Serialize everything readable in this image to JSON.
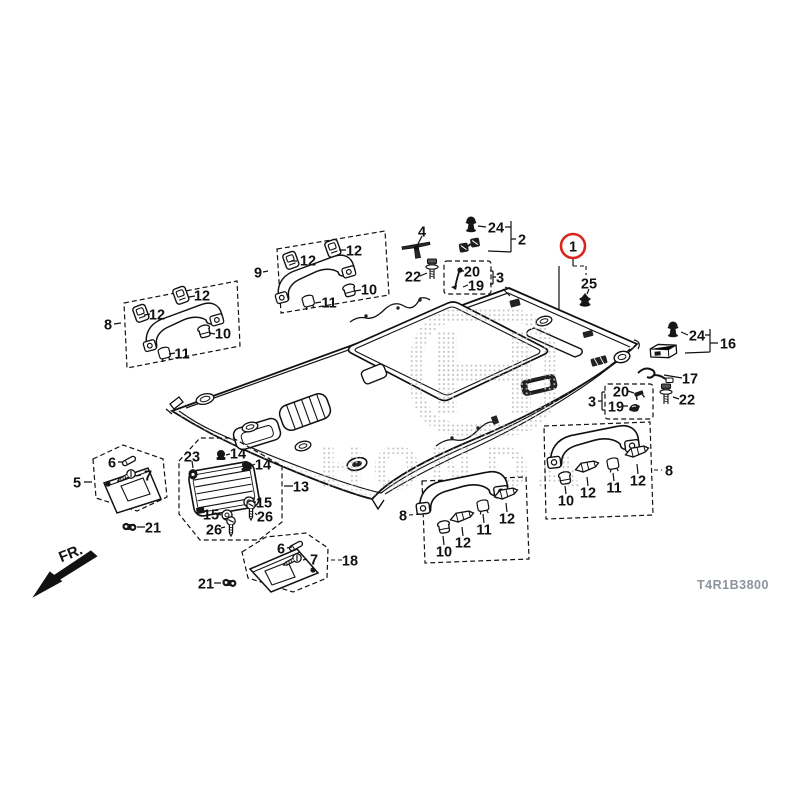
{
  "doc": {
    "part_code": "T4R1B3800",
    "fr_label": "FR.",
    "watermark": "HONDA",
    "accent_red": "#d9261c",
    "line_color": "#111111"
  },
  "callouts": [
    {
      "label": "1",
      "x": 573,
      "y": 246,
      "circled": true
    },
    {
      "label": "25",
      "x": 589,
      "y": 283
    },
    {
      "label": "4",
      "x": 422,
      "y": 231
    },
    {
      "label": "24",
      "x": 496,
      "y": 227
    },
    {
      "label": "2",
      "x": 522,
      "y": 239
    },
    {
      "label": "22",
      "x": 413,
      "y": 276
    },
    {
      "label": "20",
      "x": 472,
      "y": 271
    },
    {
      "label": "19",
      "x": 476,
      "y": 285
    },
    {
      "label": "3",
      "x": 500,
      "y": 277
    },
    {
      "label": "9",
      "x": 258,
      "y": 272
    },
    {
      "label": "12",
      "x": 308,
      "y": 260
    },
    {
      "label": "12",
      "x": 354,
      "y": 250
    },
    {
      "label": "10",
      "x": 369,
      "y": 289
    },
    {
      "label": "11",
      "x": 329,
      "y": 302
    },
    {
      "label": "8",
      "x": 108,
      "y": 324
    },
    {
      "label": "12",
      "x": 157,
      "y": 314
    },
    {
      "label": "12",
      "x": 202,
      "y": 295
    },
    {
      "label": "10",
      "x": 223,
      "y": 333
    },
    {
      "label": "11",
      "x": 182,
      "y": 353
    },
    {
      "label": "24",
      "x": 697,
      "y": 335
    },
    {
      "label": "16",
      "x": 728,
      "y": 343
    },
    {
      "label": "17",
      "x": 690,
      "y": 378
    },
    {
      "label": "3",
      "x": 592,
      "y": 401
    },
    {
      "label": "20",
      "x": 621,
      "y": 391
    },
    {
      "label": "19",
      "x": 616,
      "y": 406
    },
    {
      "label": "22",
      "x": 687,
      "y": 399
    },
    {
      "label": "5",
      "x": 77,
      "y": 482
    },
    {
      "label": "6",
      "x": 112,
      "y": 462
    },
    {
      "label": "7",
      "x": 148,
      "y": 475
    },
    {
      "label": "21",
      "x": 153,
      "y": 527
    },
    {
      "label": "23",
      "x": 192,
      "y": 456
    },
    {
      "label": "14",
      "x": 238,
      "y": 453
    },
    {
      "label": "14",
      "x": 263,
      "y": 464
    },
    {
      "label": "13",
      "x": 301,
      "y": 486
    },
    {
      "label": "15",
      "x": 264,
      "y": 502
    },
    {
      "label": "26",
      "x": 265,
      "y": 516
    },
    {
      "label": "15",
      "x": 211,
      "y": 514
    },
    {
      "label": "26",
      "x": 214,
      "y": 529
    },
    {
      "label": "18",
      "x": 350,
      "y": 560
    },
    {
      "label": "6",
      "x": 281,
      "y": 548
    },
    {
      "label": "7",
      "x": 314,
      "y": 559
    },
    {
      "label": "21",
      "x": 206,
      "y": 583
    },
    {
      "label": "8",
      "x": 403,
      "y": 515
    },
    {
      "label": "10",
      "x": 444,
      "y": 551
    },
    {
      "label": "12",
      "x": 463,
      "y": 542
    },
    {
      "label": "11",
      "x": 484,
      "y": 529
    },
    {
      "label": "12",
      "x": 507,
      "y": 518
    },
    {
      "label": "8",
      "x": 669,
      "y": 470
    },
    {
      "label": "10",
      "x": 566,
      "y": 500
    },
    {
      "label": "12",
      "x": 588,
      "y": 492
    },
    {
      "label": "11",
      "x": 614,
      "y": 487
    },
    {
      "label": "12",
      "x": 638,
      "y": 480
    }
  ]
}
